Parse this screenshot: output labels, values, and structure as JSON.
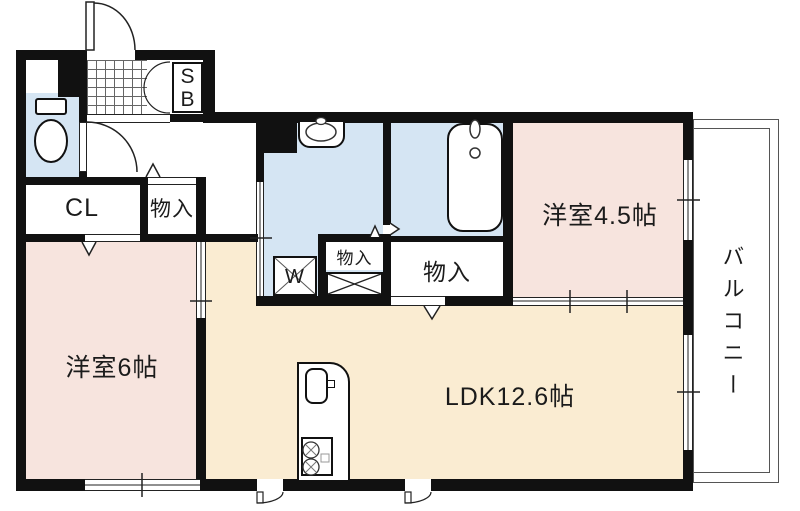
{
  "floorplan": {
    "labels": {
      "shoebox_s": "S",
      "shoebox_b": "B",
      "closet": "CL",
      "hall_storage": "物入",
      "utility_storage": "物入",
      "large_storage": "物入",
      "washer": "W",
      "western_room_6": "洋室6帖",
      "western_room_4_5": "洋室4.5帖",
      "ldk": "LDK12.6帖",
      "balcony": "バルコニー"
    },
    "colors": {
      "wall": "#111111",
      "wet_area_floor": "#d5e5f3",
      "bedroom_floor": "#f7e4de",
      "ldk_floor": "#faecd2",
      "balcony_floor": "#ffffff",
      "thin_line": "#333333"
    }
  }
}
